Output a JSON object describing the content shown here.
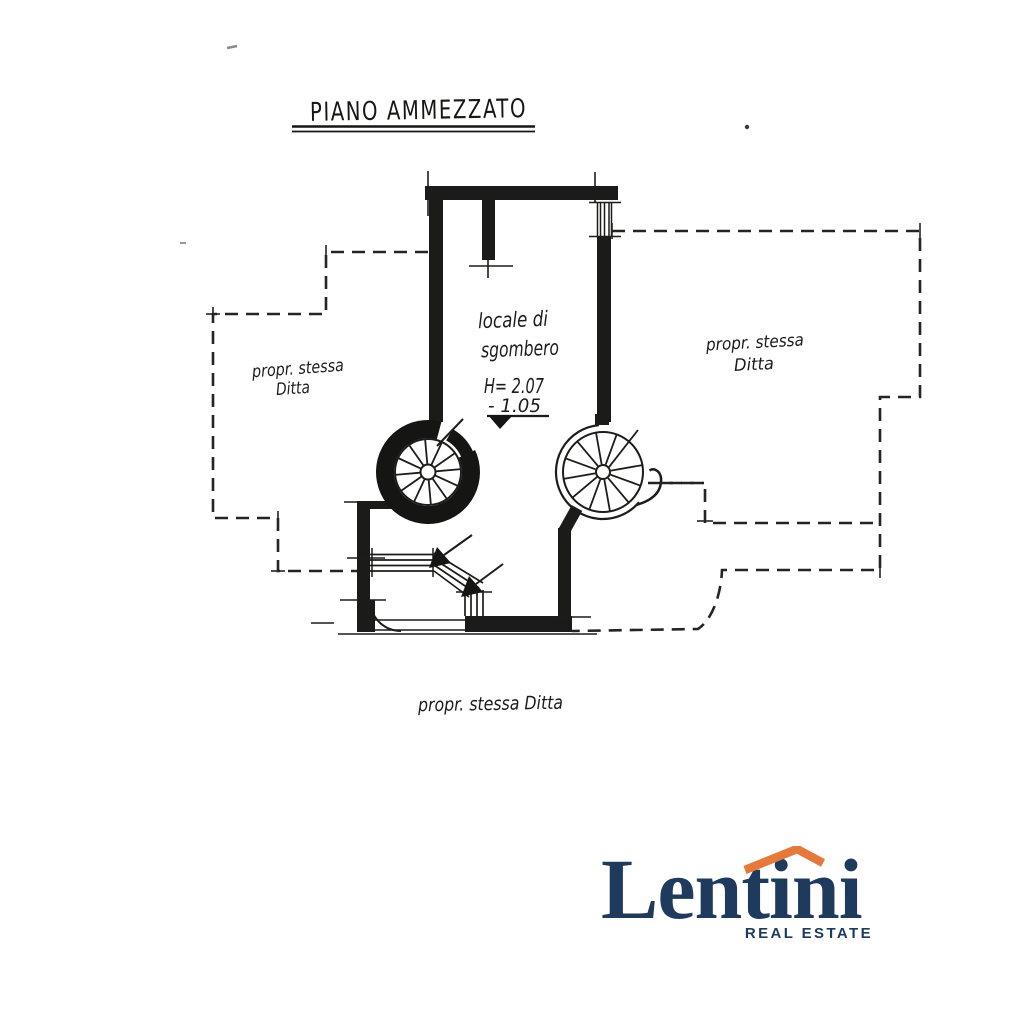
{
  "plan": {
    "title": "PIANO AMMEZZATO",
    "room_label": {
      "line1": "locale di",
      "line2": "sgombero"
    },
    "height_note": "H= 2.07",
    "level_note": "- 1.05",
    "adjacent_left": {
      "line1": "propr. stessa",
      "line2": "Ditta"
    },
    "adjacent_right": {
      "line1": "propr. stessa",
      "line2": "Ditta"
    },
    "adjacent_bottom": "propr. stessa Ditta",
    "ink_color": "#1c1c1a"
  },
  "logo": {
    "brand": "Lentini",
    "tagline": "REAL ESTATE",
    "navy": "#1e3a5c",
    "orange": "#e5793b",
    "icon": "roof-icon"
  }
}
